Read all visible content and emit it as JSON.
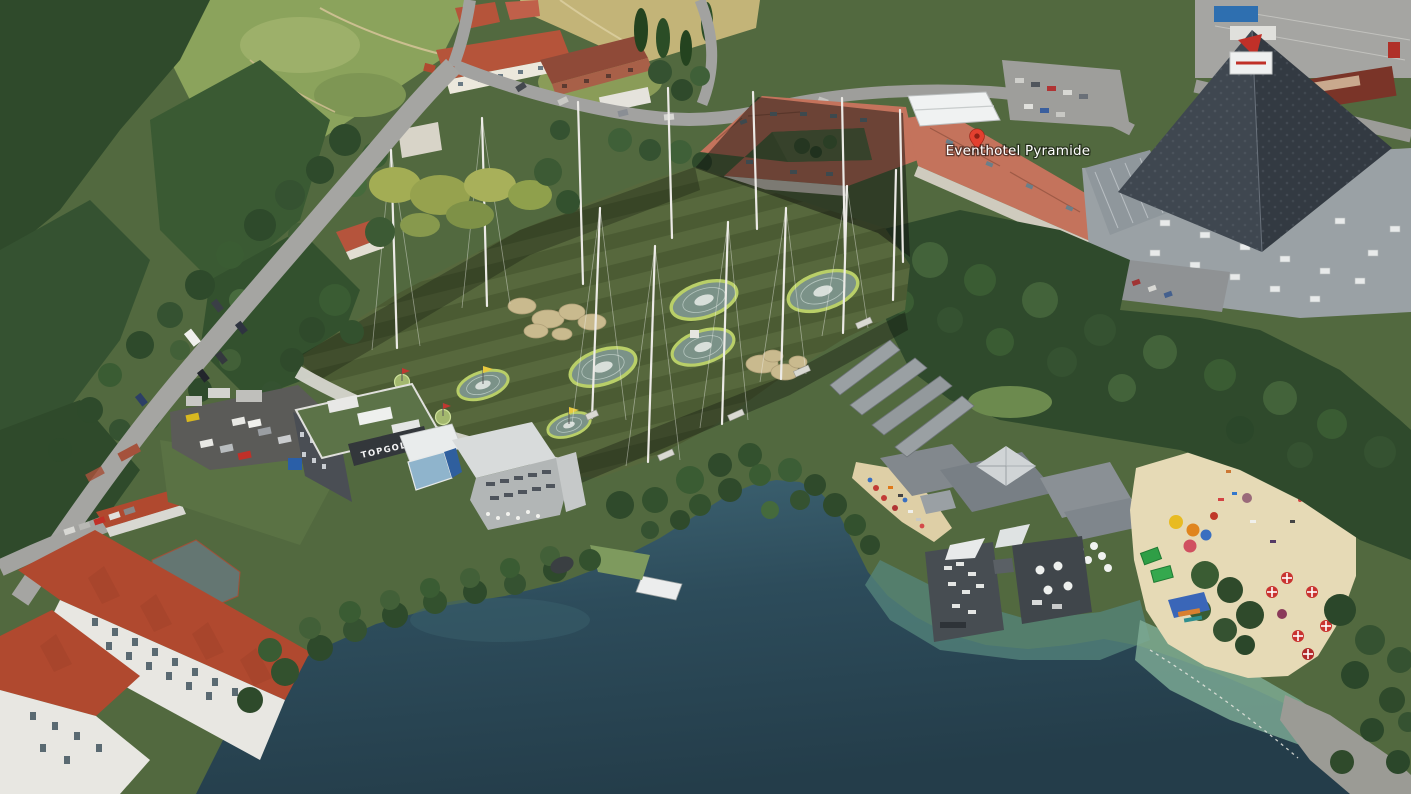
{
  "view": {
    "type": "3d-aerial-earth-view",
    "description": "Oblique 3D aerial view of a lakeside site with a rendered Topgolf driving-range development composited into the landscape"
  },
  "labels": {
    "place_marker": {
      "text": "Eventhotel Pyramide",
      "icon": "red-map-pin",
      "text_color": "#ffffff",
      "pin_color": "#e3402f"
    },
    "venue_sign": {
      "text": "TOPGOLF",
      "text_color": "#ffffff",
      "background_color": "#33373b"
    }
  },
  "scene": {
    "landmarks": [
      {
        "name": "driving-range-field",
        "description": "curved striped outfield with six circular dartboard targets, yellow and red flags, sand bunker clusters, tall white netting masts with guy wires and dark perimeter netting"
      },
      {
        "name": "topgolf-venue-building",
        "description": "grey multi-storey venue with rooftop garden, dark sign band, white entrance canopy, blue glass accents and patio"
      },
      {
        "name": "venue-parking-lot",
        "description": "dark asphalt car park with rendered cars beside the venue"
      },
      {
        "name": "eventhotel-courtyard-building",
        "description": "large hotel quadrangle with salmon-red roofs, courtyard and white marquee tent"
      },
      {
        "name": "pyramid-event-center",
        "description": "huge dark glass pyramid over a flat grey roof complex with skylights"
      },
      {
        "name": "lake",
        "description": "deep blue-green lake filling the lower right of the view"
      },
      {
        "name": "beach-club",
        "description": "lakeside club with grey roofs, pyramid pavilion, white umbrellas and two floating piers with loungers"
      },
      {
        "name": "public-beach",
        "description": "sandy beach with colorful umbrellas, red-and-white parasols, green canopies and a blue boat dock"
      },
      {
        "name": "apartment-buildings-southwest",
        "description": "white apartment blocks with red gabled tile roofs beside the shore road"
      },
      {
        "name": "residential-north",
        "description": "cream and brick apartment buildings, small houses, poplar trees and a dry field"
      },
      {
        "name": "forest-and-meadow-northwest",
        "description": "dense woodland and open scrubby meadow crossed by dirt paths"
      },
      {
        "name": "roads",
        "description": "tree-lined roads with parked cars and a white van"
      }
    ],
    "palette": {
      "field_green_light": "#57683d",
      "field_green_dark": "#4b5b33",
      "target_ring": "#b9cf68",
      "bunker_sand": "#c9ba8e",
      "netting": "rgba(12,14,12,0.5)",
      "lake_deep": "#243d4a",
      "lake_shallow": "#7fae9b",
      "beach_sand": "#e6dab6",
      "forest_dark": "#2f4a2c",
      "meadow": "#8ba35c",
      "red_roof": "#b0492f",
      "hotel_roof": "#c4735c",
      "pyramid_face": "#3f4750",
      "road_grey": "#a2a2a0",
      "umbrella_red": "#c93330",
      "dock_blue": "#3a66b8"
    }
  }
}
